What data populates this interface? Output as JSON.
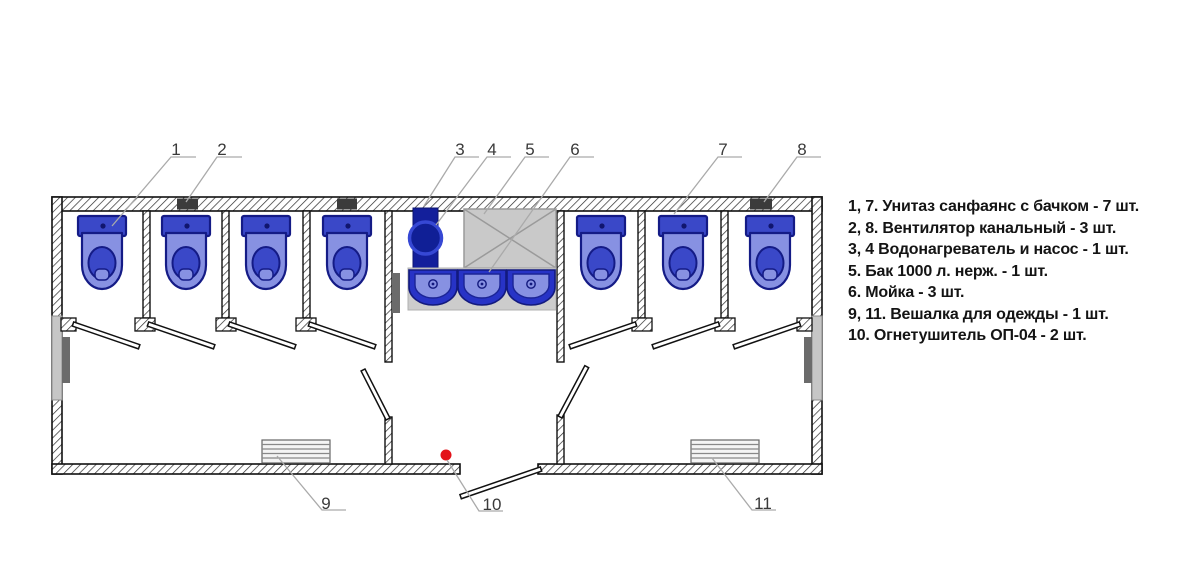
{
  "callouts": [
    "1",
    "2",
    "3",
    "4",
    "5",
    "6",
    "7",
    "8",
    "9",
    "10",
    "11"
  ],
  "legend": {
    "items": [
      "1, 7. Унитаз санфаянс с бачком - 7 шт.",
      "2, 8. Вентилятор канальный - 3 шт.",
      "3, 4 Водонагреватель и насос - 1 шт.",
      "5. Бак 1000 л. нерж. - 1 шт.",
      "6. Мойка - 3 шт.",
      "9, 11. Вешалка для одежды - 1 шт.",
      "10. Огнетушитель ОП-04 - 2 шт."
    ]
  },
  "colors": {
    "toilet_blue": "#3a48c8",
    "toilet_light_blue": "#8791e2",
    "outline_navy": "#141b86",
    "water_heater_blue": "#131f9b",
    "pump_blue": "#101f96",
    "tank_gray": "#c9c9c9",
    "counter_gray": "#cccccc",
    "vent_dark": "#3b3b3b",
    "extinguisher_red": "#e31219"
  }
}
